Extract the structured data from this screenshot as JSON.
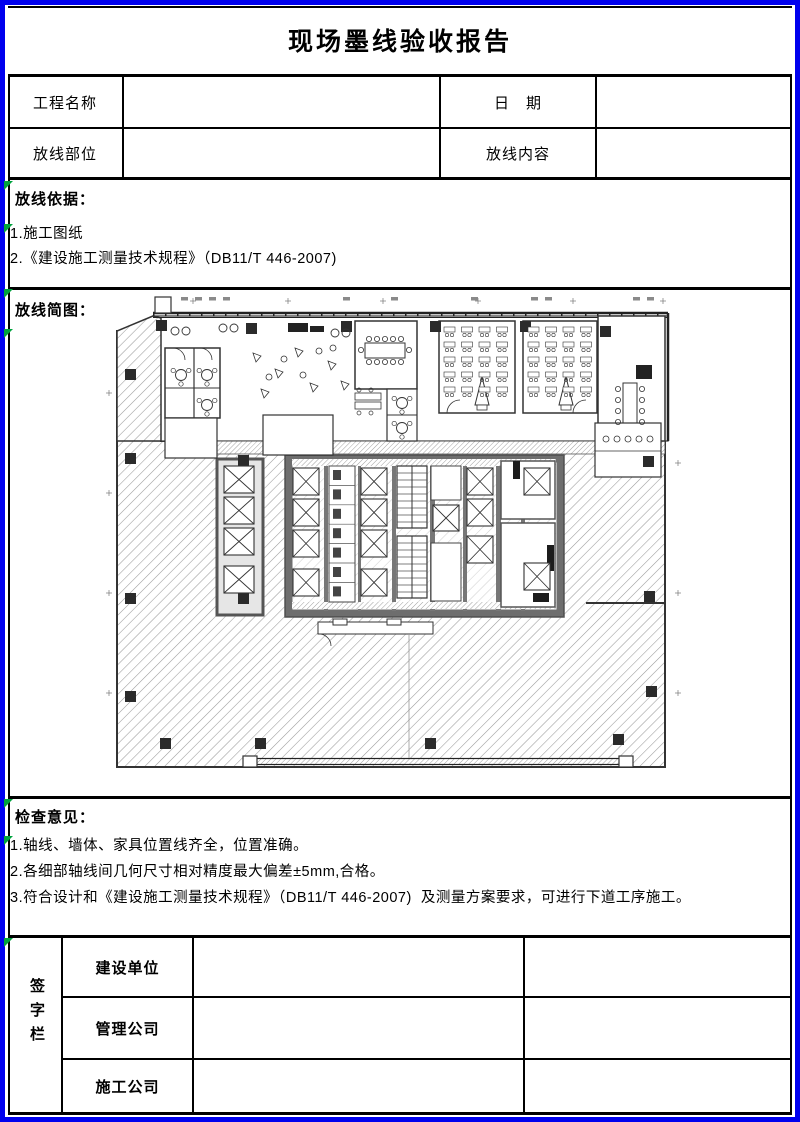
{
  "page": {
    "title": "现场墨线验收报告",
    "border_color": "#0000ee",
    "marker_color": "#00a33d"
  },
  "info_table": {
    "row1": {
      "label1": "工程名称",
      "value1": "",
      "label2": "日　期",
      "value2": ""
    },
    "row2": {
      "label1": "放线部位",
      "value1": "",
      "label2": "放线内容",
      "value2": ""
    }
  },
  "basis_section": {
    "heading": "放线依据：",
    "items": [
      "1.施工图纸",
      "2.《建设施工测量技术规程》（DB11/T 446-2007)"
    ]
  },
  "sketch_section": {
    "heading": "放线简图：",
    "figure": "office-tower-floor-plan"
  },
  "opinion_section": {
    "heading": "检查意见：",
    "items": [
      "1.轴线、墙体、家具位置线齐全，位置准确。",
      "2.各细部轴线间几何尺寸相对精度最大偏差±5mm,合格。",
      "3.符合设计和《建设施工测量技术规程》（DB11/T 446-2007)  及测量方案要求，可进行下道工序施工。"
    ]
  },
  "signature_section": {
    "side_label": "签字栏",
    "rows": [
      {
        "label": "建设单位",
        "sign": "",
        "date": ""
      },
      {
        "label": "管理公司",
        "sign": "",
        "date": ""
      },
      {
        "label": "施工公司",
        "sign": "",
        "date": ""
      }
    ]
  }
}
